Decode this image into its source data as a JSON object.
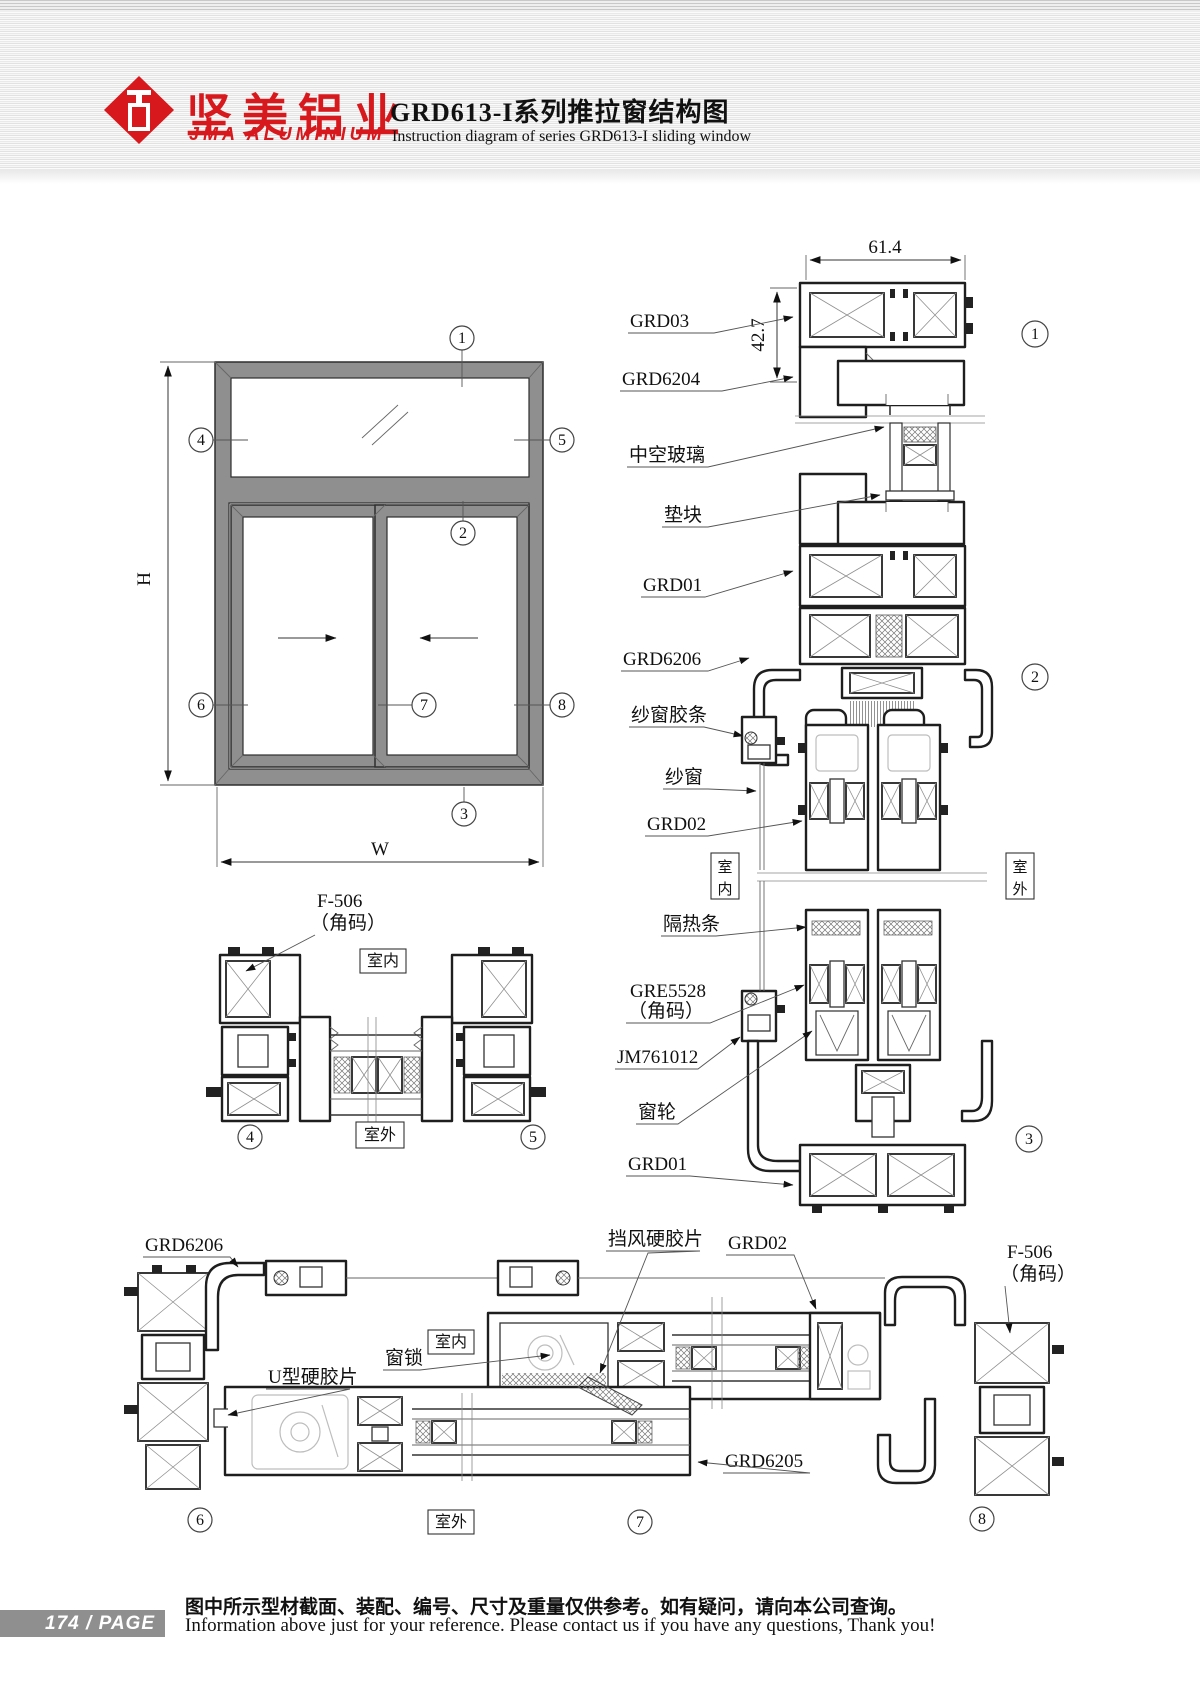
{
  "header": {
    "logo_cn": "坚美铝业",
    "logo_en": "JMA ALUMINIUM",
    "title_cn": "GRD613-I系列推拉窗结构图",
    "title_en": "Instruction diagram of series GRD613-I sliding window"
  },
  "dims": {
    "w614": "61.4",
    "h427": "42.7",
    "height": "H",
    "width": "W"
  },
  "balloons": {
    "n1": "1",
    "n2": "2",
    "n3": "3",
    "n4": "4",
    "n5": "5",
    "n6": "6",
    "n7": "7",
    "n8": "8"
  },
  "markers": {
    "indoor": "室内",
    "outdoor": "室外",
    "indoor_v1": "室",
    "indoor_v2": "内",
    "outdoor_v1": "室",
    "outdoor_v2": "外"
  },
  "labels": {
    "grd03": "GRD03",
    "grd6204": "GRD6204",
    "insulating_glass": "中空玻璃",
    "spacer": "垫块",
    "grd01": "GRD01",
    "grd6206": "GRD6206",
    "screen_gasket": "纱窗胶条",
    "screen": "纱窗",
    "grd02": "GRD02",
    "thermal_break": "隔热条",
    "gre5528": "GRE5528",
    "bracket_note": "（角码）",
    "jm761012": "JM761012",
    "roller": "窗轮",
    "f506": "F-506",
    "u_strip": "U型硬胶片",
    "window_lock": "窗锁",
    "wind_strip": "挡风硬胶片",
    "grd6205": "GRD6205"
  },
  "footer": {
    "page_number": "174",
    "separator": "/",
    "page_label": "PAGE",
    "note_cn": "图中所示型材截面、装配、编号、尺寸及重量仅供参考。如有疑问，请向本公司查询。",
    "note_en": "Information above just for your reference. Please contact us if you have any questions, Thank you!"
  }
}
